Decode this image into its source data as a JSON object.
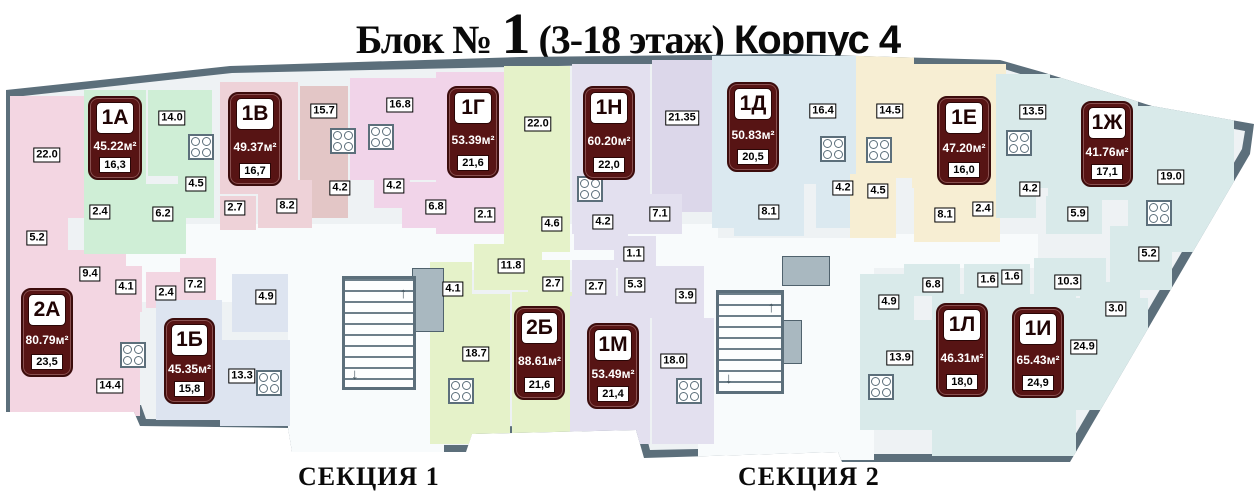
{
  "title": {
    "block_label": "Блок №",
    "block_number": "1",
    "floors": "(3-18 этаж)",
    "building": "Корпус 4"
  },
  "sections": [
    {
      "label": "СЕКЦИЯ 1"
    },
    {
      "label": "СЕКЦИЯ 2"
    }
  ],
  "apartments": [
    {
      "code": "1А",
      "total_area": "45.22м²",
      "living_area": "16,3",
      "rooms": [
        "14.0",
        "4.5",
        "2.4",
        "6.2"
      ]
    },
    {
      "code": "1В",
      "total_area": "49.37м²",
      "living_area": "16,7",
      "rooms": [
        "15.7",
        "4.2",
        "2.7",
        "8.2"
      ]
    },
    {
      "code": "1Г",
      "total_area": "53.39м²",
      "living_area": "21,6",
      "rooms": [
        "16.8",
        "4.2",
        "6.8",
        "2.1"
      ]
    },
    {
      "code": "1Н",
      "total_area": "60.20м²",
      "living_area": "22,0",
      "rooms": [
        "21.35",
        "4.2",
        "7.1",
        "1.1"
      ]
    },
    {
      "code": "1Д",
      "total_area": "50.83м²",
      "living_area": "20,5",
      "rooms": [
        "16.4",
        "4.2",
        "8.1"
      ]
    },
    {
      "code": "1Е",
      "total_area": "47.20м²",
      "living_area": "16,0",
      "rooms": [
        "14.5",
        "4.5",
        "8.1",
        "2.4"
      ]
    },
    {
      "code": "1Ж",
      "total_area": "41.76м²",
      "living_area": "17,1",
      "rooms": [
        "13.5",
        "4.2",
        "5.9"
      ]
    },
    {
      "code": "2А",
      "total_area": "80.79м²",
      "living_area": "23,5",
      "rooms": [
        "22.0",
        "5.2",
        "9.4",
        "4.1",
        "2.4",
        "7.2",
        "14.4"
      ]
    },
    {
      "code": "1Б",
      "total_area": "45.35м²",
      "living_area": "15,8",
      "rooms": [
        "4.9",
        "13.3"
      ]
    },
    {
      "code": "2Б",
      "total_area": "88.61м²",
      "living_area": "21,6",
      "rooms": [
        "22.0",
        "4.6",
        "11.8",
        "4.1",
        "2.7",
        "18.7"
      ]
    },
    {
      "code": "1М",
      "total_area": "53.49м²",
      "living_area": "21,4",
      "rooms": [
        "2.7",
        "5.3",
        "3.9",
        "18.0"
      ]
    },
    {
      "code": "1Л",
      "total_area": "46.31м²",
      "living_area": "18,0",
      "rooms": [
        "6.8",
        "4.9",
        "13.9",
        "1.6"
      ]
    },
    {
      "code": "1И",
      "total_area": "65.43м²",
      "living_area": "24,9",
      "rooms": [
        "1.6",
        "10.3",
        "24.9",
        "5.2",
        "3.0",
        "19.0"
      ]
    }
  ],
  "colors": {
    "wall": "#5c6f7b",
    "interior": "#eef2f4",
    "corridor": "#f8fbfc",
    "badge_bg": "#571414",
    "badge_text": "#ffffff",
    "room_pink": "#f3d6e2",
    "room_green": "#cfeed6",
    "room_rose": "#eed2d8",
    "room_dusty_rose": "#e3c6c6",
    "room_magenta": "#f1d4e9",
    "room_yellow_green": "#e5f2c9",
    "room_lavender": "#e3e0ef",
    "room_lavender_dark": "#dcd7ea",
    "room_blue": "#dbe9f0",
    "room_cream": "#f7eed3",
    "room_cyan": "#d9eaea",
    "room_blue_grey": "#dde4f0",
    "lift_grey": "#a9b8c0"
  }
}
